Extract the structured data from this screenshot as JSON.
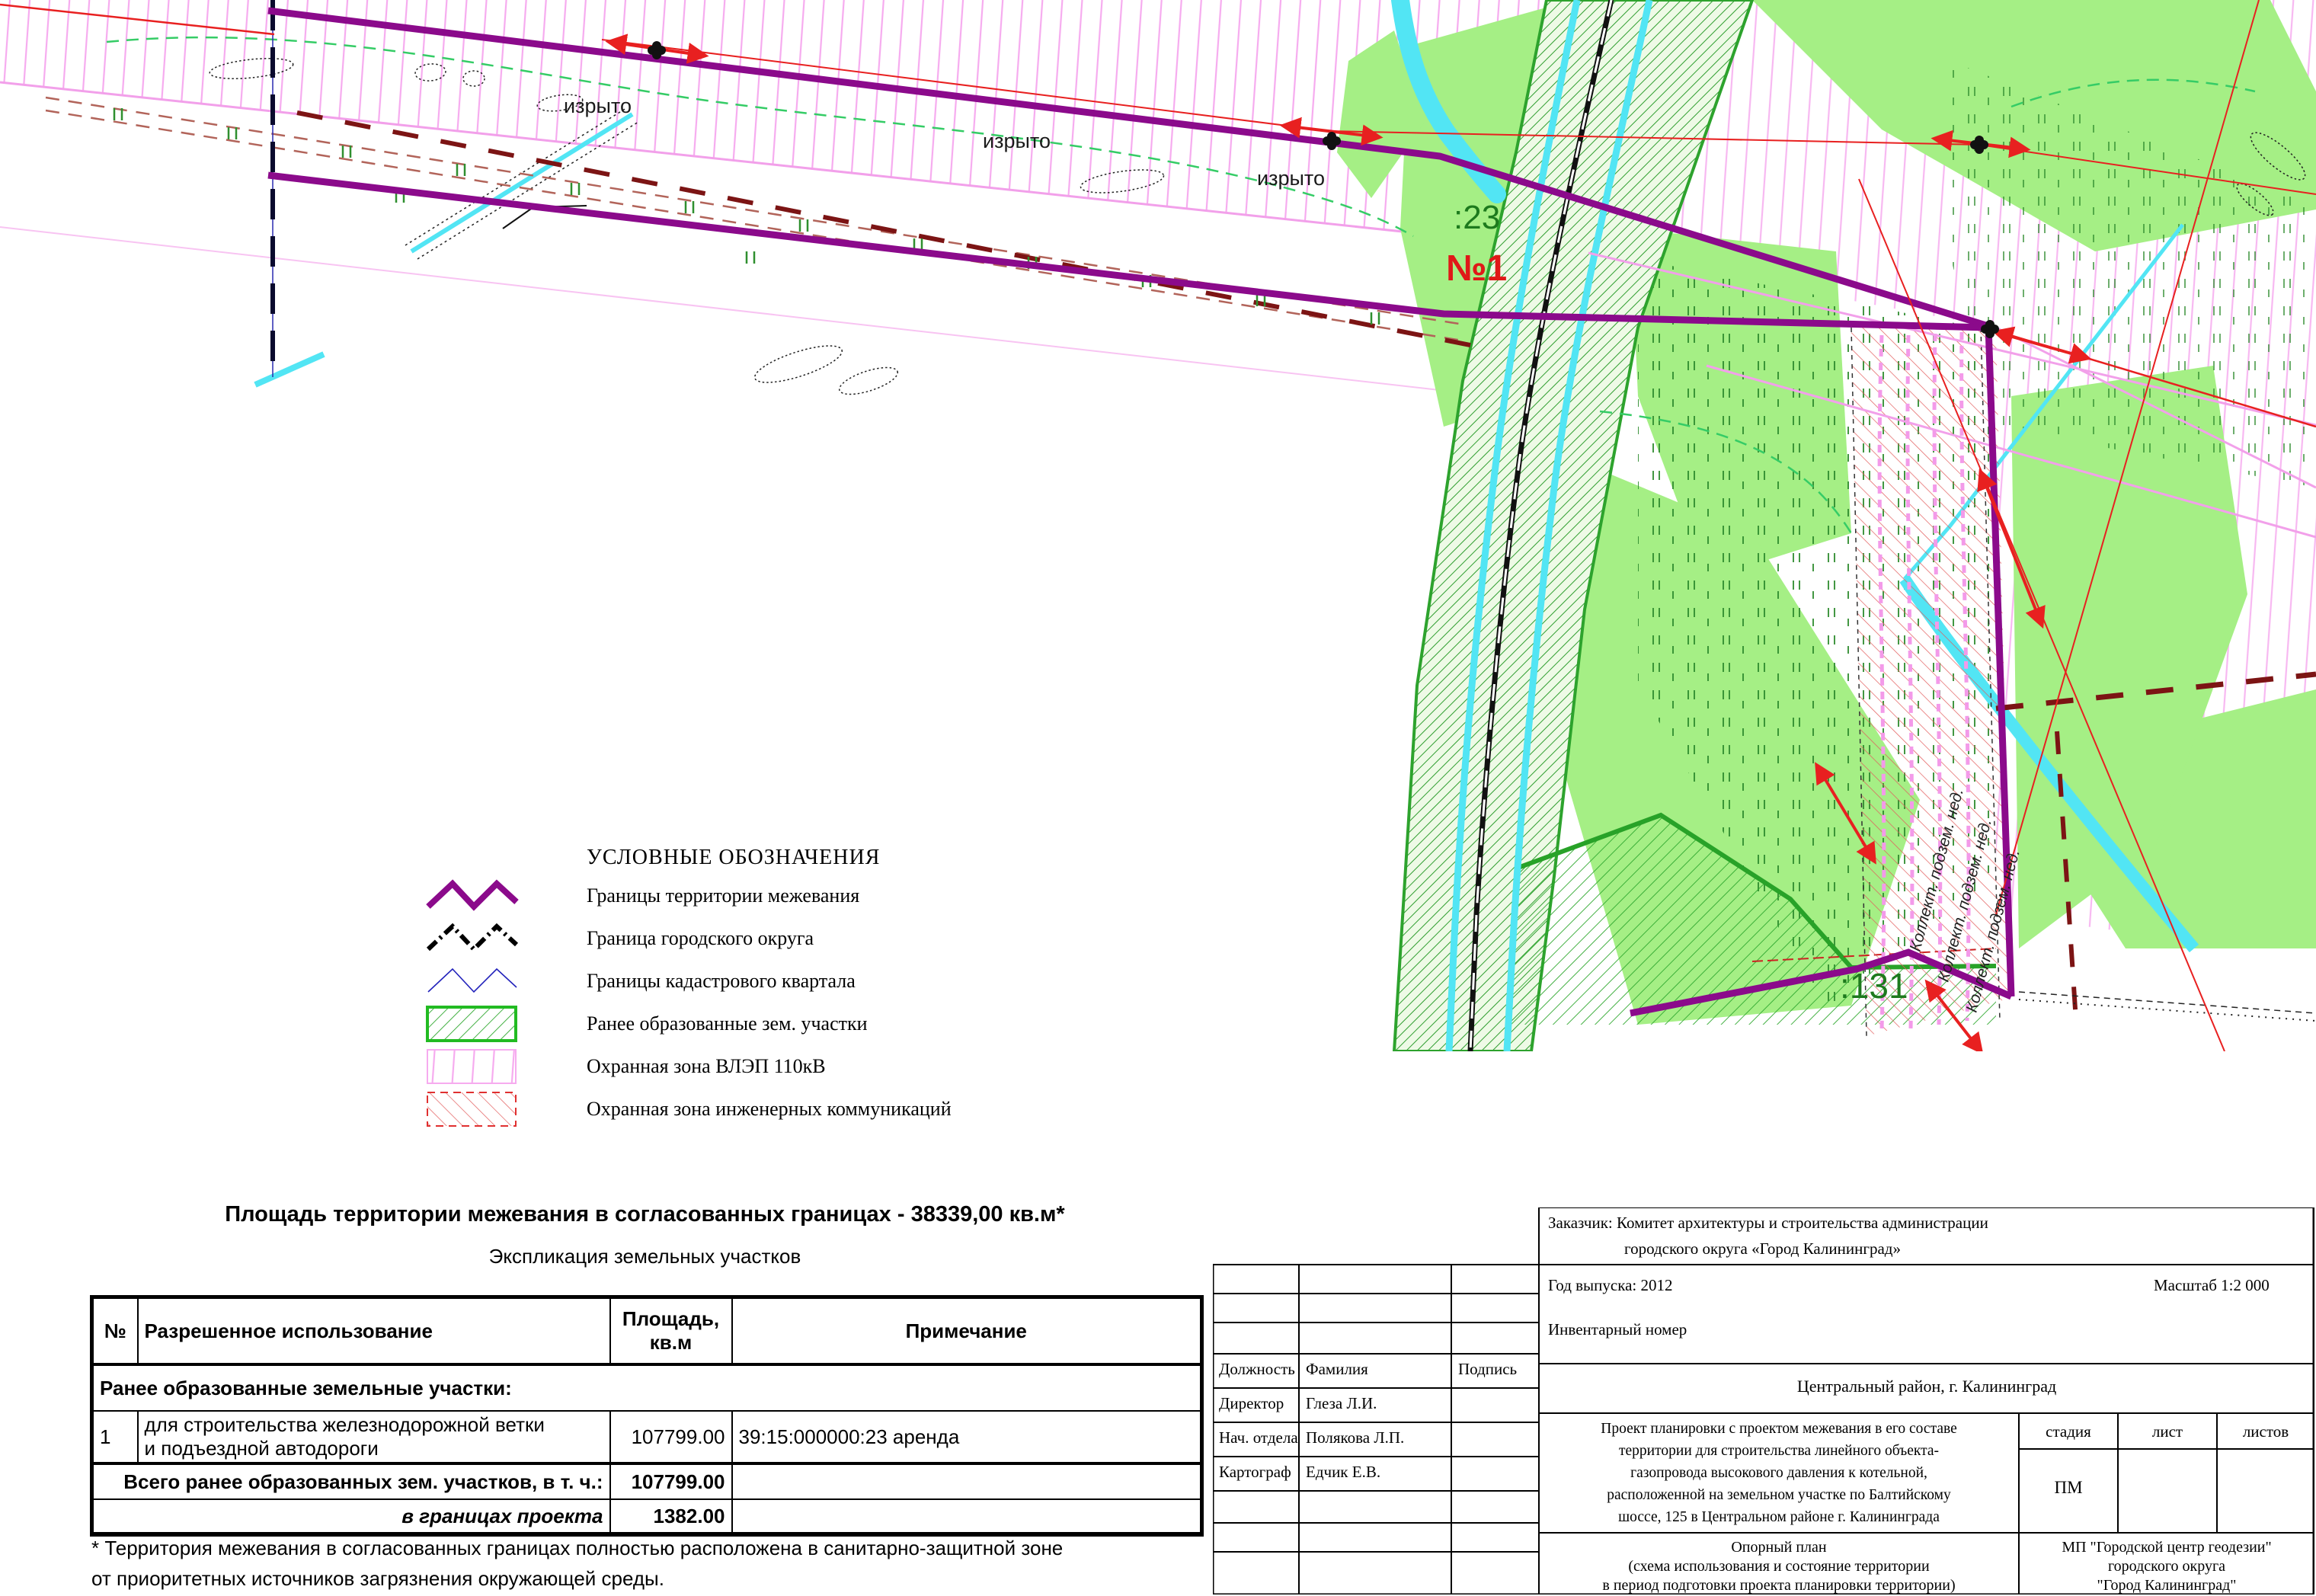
{
  "map": {
    "labels": {
      "izryto": "изрыто",
      "parcel23": ":23",
      "site1": "№1",
      "parcel131": ":131",
      "collector": "Коллект. подзем. нед."
    },
    "colors": {
      "territory_boundary": "#8b0a8b",
      "city_boundary": "#000000",
      "cadastral_quarter": "#2222bb",
      "parcel_hatch": "#2fa82f",
      "vlep_zone": "#f6abef",
      "engineering_zone": "#e03030",
      "water": "#52e5f4",
      "vegetation": "#a5ef85",
      "power_line": "#e82020"
    }
  },
  "legend": {
    "title": "УСЛОВНЫЕ ОБОЗНАЧЕНИЯ",
    "items": [
      {
        "id": "territory",
        "label": "Границы территории межевания"
      },
      {
        "id": "city-okrug",
        "label": "Граница городского округа"
      },
      {
        "id": "cadastral-quarter",
        "label": "Границы кадастрового квартала"
      },
      {
        "id": "prior-parcels",
        "label": "Ранее образованные зем. участки"
      },
      {
        "id": "vlep-zone",
        "label": "Охранная зона ВЛЭП 110кВ"
      },
      {
        "id": "eng-zone",
        "label": "Охранная зона инженерных коммуникаций"
      }
    ]
  },
  "summary": {
    "area_line": "Площадь территории межевания в согласованных границах - 38339,00 кв.м*",
    "table_title": "Экспликация земельных участков"
  },
  "table": {
    "headers": {
      "num": "№",
      "use": "Разрешенное использование",
      "area_line1": "Площадь,",
      "area_line2": "кв.м",
      "note": "Примечание"
    },
    "section": "Ранее образованные земельные участки:",
    "rows": [
      {
        "num": "1",
        "use_line1": "для строительства железнодорожной ветки",
        "use_line2": "и подъездной автодороги",
        "area": "107799.00",
        "note": "39:15:000000:23   аренда"
      }
    ],
    "total": {
      "label": "Всего ранее образованных зем. участков, в т. ч.:",
      "area": "107799.00"
    },
    "within_project": {
      "label": "в границах проекта",
      "area": "1382.00"
    }
  },
  "footnote": {
    "line1": "* Территория межевания в согласованных границах  полностью расположена в санитарно-защитной зоне",
    "line2": "от приоритетных источников загрязнения окружающей среды."
  },
  "stamp": {
    "customer_line1": "Заказчик: Комитет архитектуры и строительства администрации",
    "customer_line2": "городского округа «Город Калининград»",
    "year": "Год выпуска: 2012",
    "scale": "Масштаб 1:2 000",
    "inventory": "Инвентарный номер",
    "columns": {
      "position": "Должность",
      "surname": "Фамилия",
      "signature": "Подпись"
    },
    "people": [
      {
        "position": "Директор",
        "surname": "Глеза Л.И."
      },
      {
        "position": "Нач. отдела",
        "surname": "Полякова Л.П."
      },
      {
        "position": "Картограф",
        "surname": "Едчик Е.В."
      }
    ],
    "district": "Центральный район, г. Калининград",
    "project_lines": [
      "Проект планировки с проектом межевания в его составе",
      "территории для строительства линейного объекта-",
      "газопровода высокового давления к котельной,",
      "расположенной на земельном участке по Балтийскому",
      "шоссе, 125 в Центральном районе г. Калининграда"
    ],
    "stage_label": "стадия",
    "sheet_label": "лист",
    "sheets_label": "листов",
    "stage_value": "ПМ",
    "plan_lines": [
      "Опорный план",
      "(схема использования и состояние территории",
      "в период подготовки проекта планировки территории)"
    ],
    "org_lines": [
      "МП \"Городской центр геодезии\"",
      "городского округа",
      "\"Город Калининград\""
    ]
  }
}
